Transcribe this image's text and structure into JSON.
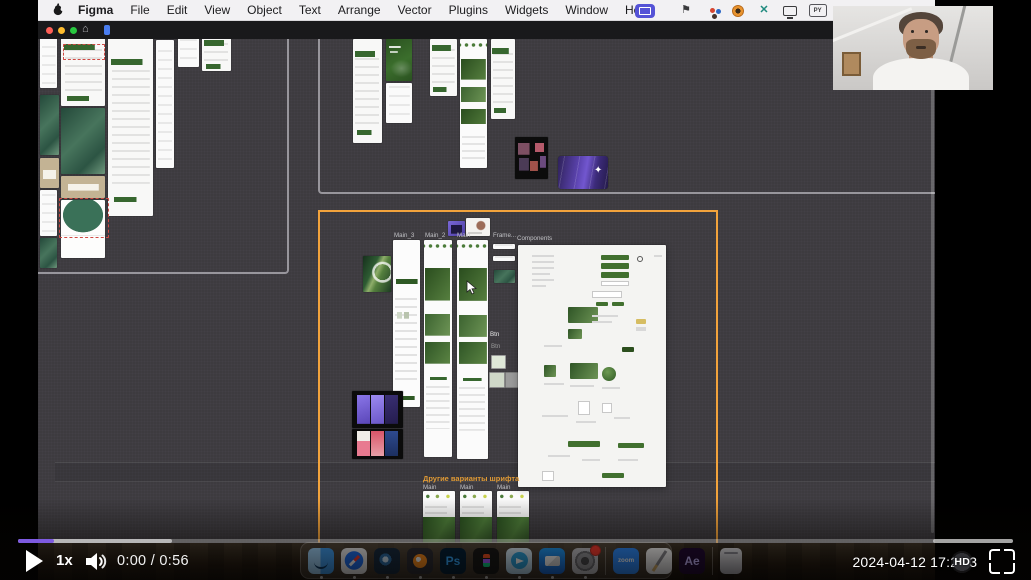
{
  "menu_bar": {
    "apple_icon": "apple-logo",
    "items": [
      "Figma",
      "File",
      "Edit",
      "View",
      "Object",
      "Text",
      "Arrange",
      "Vector",
      "Plugins",
      "Widgets",
      "Window",
      "Help"
    ],
    "status_icons": [
      "screen-sharing-indicator",
      "input-flag-icon",
      "palette-icon",
      "browser-icon",
      "teal-x-icon",
      "display-icon",
      "py-badge-icon"
    ],
    "py_badge": "PY"
  },
  "figma_window": {
    "traffic_lights": [
      "#ff5f57",
      "#febc2e",
      "#28c840"
    ],
    "home_icon": "home-icon",
    "tab_icon": "figma-file-tab"
  },
  "canvas": {
    "background": "#3d3b3f",
    "selection_color": "#f2a33c",
    "section_border_color": "#98969c",
    "sections": {
      "left": [
        -60,
        -20,
        307,
        251
      ],
      "top": [
        280,
        -9,
        622,
        160
      ],
      "selected_orange": [
        280,
        171,
        396,
        340
      ]
    },
    "band": [
      17,
      423,
      880,
      18
    ],
    "scrollbar": [
      893,
      6,
      3,
      488
    ],
    "labels": [
      [
        356,
        193,
        "Main_3"
      ],
      [
        387,
        193,
        "Main_2"
      ],
      [
        419,
        193,
        "Main"
      ],
      [
        455,
        193,
        "Frame..."
      ],
      [
        479,
        196,
        "Components"
      ],
      [
        452,
        292,
        "Btn",
        "#e8e8e8"
      ],
      [
        453,
        304,
        "Btn",
        "#9a9a9a"
      ],
      [
        385,
        445,
        "Main"
      ],
      [
        422,
        445,
        "Main"
      ],
      [
        459,
        445,
        "Main"
      ]
    ],
    "heading": {
      "text": "Другие варианты шрифта",
      "x": 385,
      "y": 436,
      "color": "#e09a35"
    },
    "frames": [
      [
        2,
        -6,
        17,
        55,
        "white"
      ],
      [
        23,
        -3,
        44,
        70,
        "green-rows"
      ],
      [
        25,
        5,
        40,
        14,
        "red-dash"
      ],
      [
        23,
        69,
        44,
        66,
        "teal"
      ],
      [
        23,
        137,
        44,
        22,
        "tan"
      ],
      [
        23,
        161,
        44,
        58,
        "arch"
      ],
      [
        21,
        159,
        48,
        38,
        "red-dash"
      ],
      [
        70,
        -1,
        45,
        178,
        "green-rows"
      ],
      [
        118,
        1,
        18,
        128,
        "white"
      ],
      [
        140,
        -2,
        21,
        30,
        "white"
      ],
      [
        164,
        -2,
        29,
        34,
        "green-rows"
      ],
      [
        2,
        56,
        19,
        60,
        "teal"
      ],
      [
        2,
        119,
        19,
        30,
        "tan"
      ],
      [
        2,
        151,
        17,
        46,
        "white"
      ],
      [
        2,
        199,
        17,
        30,
        "teal"
      ],
      [
        315,
        0,
        29,
        104,
        "green-rows"
      ],
      [
        348,
        0,
        26,
        42,
        "dark-green"
      ],
      [
        348,
        44,
        26,
        40,
        "white"
      ],
      [
        392,
        0,
        27,
        57,
        "green-rows"
      ],
      [
        422,
        0,
        27,
        129,
        "collage"
      ],
      [
        453,
        0,
        24,
        80,
        "green-rows"
      ],
      [
        477,
        98,
        33,
        42,
        "thumb-grid"
      ],
      [
        520,
        117,
        50,
        33,
        "purple-card"
      ],
      [
        556,
        127,
        10,
        12,
        "sparkle"
      ],
      [
        410,
        182,
        17,
        15,
        "purple-thumb"
      ],
      [
        428,
        179,
        24,
        18,
        "photo-card"
      ],
      [
        455,
        205,
        22,
        5,
        "white"
      ],
      [
        455,
        217,
        22,
        5,
        "white"
      ],
      [
        456,
        231,
        21,
        13,
        "teal"
      ],
      [
        325,
        217,
        28,
        36,
        "leaf"
      ],
      [
        355,
        201,
        27,
        167,
        "main-list"
      ],
      [
        386,
        201,
        28,
        217,
        "main-rich"
      ],
      [
        419,
        201,
        31,
        219,
        "main-rich"
      ],
      [
        453,
        316,
        13,
        12,
        "swatch-light"
      ],
      [
        451,
        333,
        14,
        14,
        "swatch-sage"
      ],
      [
        467,
        333,
        14,
        14,
        "swatch-gray"
      ],
      [
        314,
        352,
        51,
        37,
        "phones-purple"
      ],
      [
        314,
        390,
        51,
        30,
        "phones-color"
      ],
      [
        385,
        452,
        32,
        54,
        "font-variant"
      ],
      [
        422,
        452,
        32,
        54,
        "font-variant"
      ],
      [
        459,
        452,
        32,
        54,
        "font-variant"
      ]
    ],
    "components_frame": {
      "x": 480,
      "y": 206,
      "w": 148,
      "h": 242,
      "children": [
        [
          83,
          10,
          28,
          5,
          "g"
        ],
        [
          83,
          18,
          28,
          6,
          "g"
        ],
        [
          83,
          27,
          28,
          6,
          "g"
        ],
        [
          83,
          36,
          28,
          5,
          "ol"
        ],
        [
          14,
          10,
          22,
          2,
          "ln"
        ],
        [
          14,
          16,
          22,
          2,
          "ln"
        ],
        [
          14,
          22,
          22,
          2,
          "ln"
        ],
        [
          14,
          28,
          18,
          2,
          "ln"
        ],
        [
          14,
          34,
          22,
          2,
          "ln"
        ],
        [
          14,
          40,
          14,
          2,
          "ln"
        ],
        [
          119,
          11,
          6,
          6,
          "tg"
        ],
        [
          136,
          10,
          8,
          2,
          "ln"
        ],
        [
          74,
          46,
          30,
          7,
          "ol"
        ],
        [
          78,
          57,
          12,
          4,
          "g"
        ],
        [
          94,
          57,
          12,
          4,
          "g"
        ],
        [
          50,
          62,
          30,
          16,
          "gi"
        ],
        [
          50,
          84,
          14,
          10,
          "gi"
        ],
        [
          74,
          70,
          26,
          2,
          "ln"
        ],
        [
          74,
          76,
          20,
          2,
          "ln"
        ],
        [
          118,
          74,
          10,
          5,
          "y"
        ],
        [
          118,
          82,
          10,
          4,
          "ln"
        ],
        [
          104,
          102,
          12,
          5,
          "dg"
        ],
        [
          26,
          100,
          18,
          2,
          "ln"
        ],
        [
          52,
          118,
          28,
          16,
          "gi"
        ],
        [
          84,
          122,
          14,
          14,
          "gc"
        ],
        [
          26,
          120,
          12,
          12,
          "gi"
        ],
        [
          26,
          138,
          20,
          2,
          "ln"
        ],
        [
          52,
          140,
          24,
          2,
          "ln"
        ],
        [
          84,
          142,
          18,
          2,
          "ln"
        ],
        [
          60,
          156,
          12,
          14,
          "ol"
        ],
        [
          84,
          158,
          10,
          10,
          "ol"
        ],
        [
          24,
          170,
          26,
          2,
          "ln"
        ],
        [
          58,
          176,
          20,
          2,
          "ln"
        ],
        [
          96,
          172,
          16,
          2,
          "ln"
        ],
        [
          50,
          196,
          32,
          6,
          "g"
        ],
        [
          100,
          198,
          26,
          5,
          "g"
        ],
        [
          30,
          210,
          22,
          2,
          "ln"
        ],
        [
          64,
          214,
          18,
          2,
          "ln"
        ],
        [
          100,
          214,
          20,
          2,
          "ln"
        ],
        [
          84,
          228,
          22,
          5,
          "g"
        ],
        [
          24,
          226,
          12,
          10,
          "ol"
        ]
      ]
    },
    "cursor": {
      "x": 428,
      "y": 241
    }
  },
  "webcam": {
    "subject": "presenter-on-camera"
  },
  "dock": {
    "items": [
      {
        "id": "finder",
        "name": "finder"
      },
      {
        "id": "safari",
        "name": "safari"
      },
      {
        "id": "cinema4d",
        "name": "cinema-4d"
      },
      {
        "id": "blender",
        "name": "blender"
      },
      {
        "id": "photoshop",
        "name": "photoshop",
        "label": "Ps"
      },
      {
        "id": "figma",
        "name": "figma"
      },
      {
        "id": "telegram",
        "name": "telegram"
      },
      {
        "id": "mail",
        "name": "mail"
      },
      {
        "id": "settings",
        "name": "system-settings",
        "badge": true
      },
      {
        "id": "sep"
      },
      {
        "id": "zoom",
        "name": "zoom",
        "label": "zoom"
      },
      {
        "id": "notes",
        "name": "notes"
      },
      {
        "id": "ae",
        "name": "after-effects",
        "label": "Ae"
      },
      {
        "id": "sep"
      },
      {
        "id": "trash",
        "name": "trash"
      }
    ],
    "running_dots": 9
  },
  "player": {
    "speed": "1x",
    "time": "0:00 / 0:56",
    "date_prefix": "2024-04-12 17:2",
    "date_tail": "3",
    "quality_badge": "HD",
    "progress": {
      "played_pct": 3.6,
      "buffered_pct": 15.5,
      "tail_start_pct": 92,
      "tail_width_pct": 8,
      "accent": "#7d5ae0"
    }
  }
}
